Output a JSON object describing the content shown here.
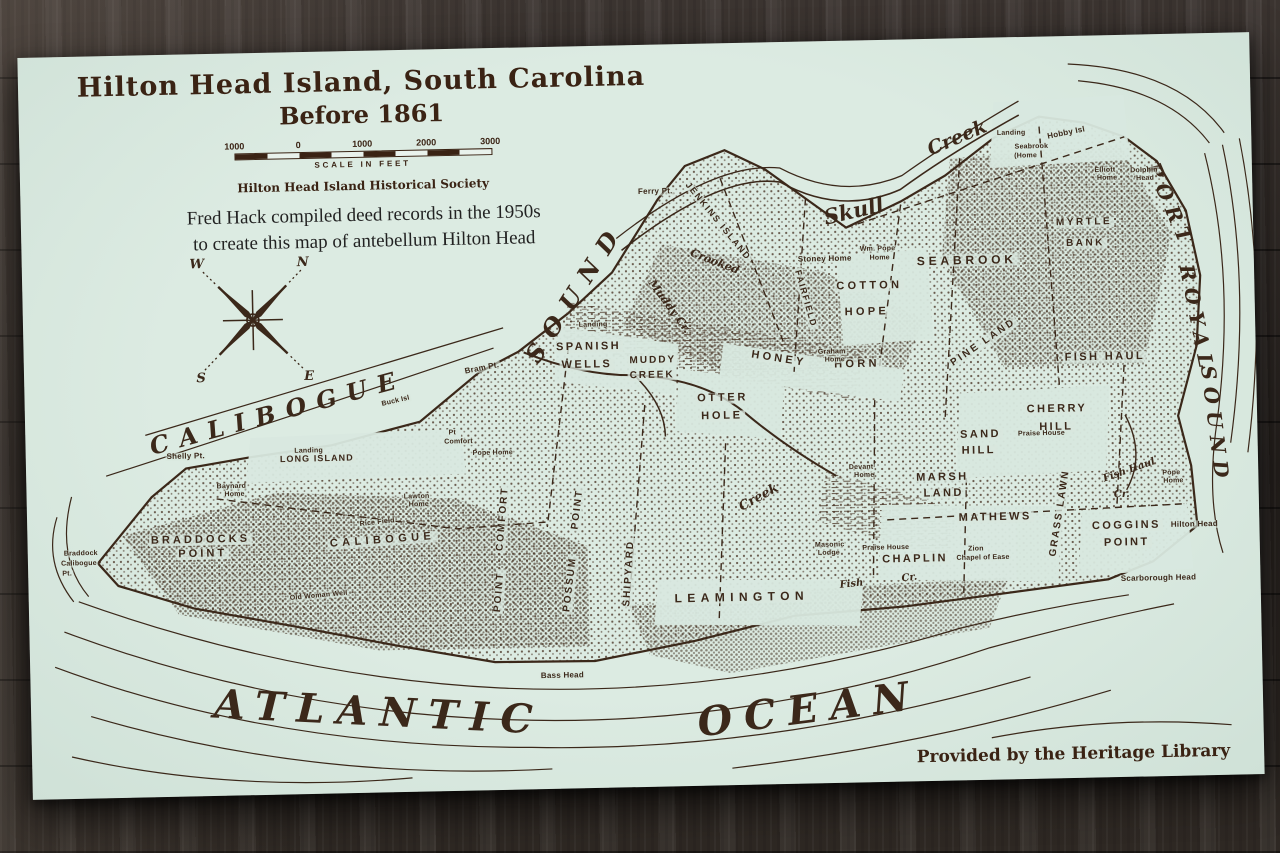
{
  "colors": {
    "paper": "#d6e7de",
    "ink": "#3b281a",
    "wood_dark": "#241f1c",
    "wood_light": "#4b433d"
  },
  "header": {
    "title_line1": "Hilton Head Island,  South Carolina",
    "title_line2": "Before 1861",
    "scale_ticks": [
      "1000",
      "0",
      "1000",
      "2000",
      "3000"
    ],
    "scale_caption": "SCALE IN FEET",
    "society": "Hilton Head Island Historical Society",
    "caption_line1": "Fred Hack compiled deed records in the 1950s",
    "caption_line2": "to create this map of antebellum Hilton Head"
  },
  "compass": {
    "n": "N",
    "e": "E",
    "s": "S",
    "w": "W"
  },
  "credit": "Provided by the Heritage Library",
  "labels": [
    {
      "t": "CALIBOGUE",
      "x": 253,
      "y": 360,
      "s": 24,
      "cls": "water-lg",
      "r": -14,
      "ls": 0.45
    },
    {
      "t": "SOUND",
      "x": 553,
      "y": 246,
      "s": 24,
      "cls": "water-lg",
      "r": -56,
      "ls": 0.5
    },
    {
      "t": "ATLANTIC",
      "x": 348,
      "y": 662,
      "s": 40,
      "cls": "ocean",
      "r": 4,
      "ls": 0.3
    },
    {
      "t": "OCEAN",
      "x": 778,
      "y": 668,
      "s": 40,
      "cls": "ocean",
      "r": -6,
      "ls": 0.3
    },
    {
      "t": "PORT",
      "x": 1150,
      "y": 172,
      "s": 20,
      "cls": "water-lg",
      "r": 68,
      "ls": 0.35
    },
    {
      "t": "ROYAL",
      "x": 1174,
      "y": 286,
      "s": 20,
      "cls": "water-lg",
      "r": 80,
      "ls": 0.35
    },
    {
      "t": "SOUND",
      "x": 1190,
      "y": 392,
      "s": 20,
      "cls": "water-lg",
      "r": 84,
      "ls": 0.35
    },
    {
      "t": "Skull",
      "x": 833,
      "y": 170,
      "s": 21,
      "cls": "script",
      "r": -12
    },
    {
      "t": "Creek",
      "x": 938,
      "y": 100,
      "s": 19,
      "cls": "script",
      "r": -22
    },
    {
      "t": "Muddy Cr.",
      "x": 647,
      "y": 262,
      "s": 11,
      "cls": "script",
      "r": 55
    },
    {
      "t": "Crooked",
      "x": 693,
      "y": 218,
      "s": 11,
      "cls": "script",
      "r": 22
    },
    {
      "t": "Creek",
      "x": 732,
      "y": 455,
      "s": 13,
      "cls": "script",
      "r": -28
    },
    {
      "t": "Fish Haul",
      "x": 1103,
      "y": 436,
      "s": 10,
      "cls": "script",
      "r": -18
    },
    {
      "t": "Cr.",
      "x": 1095,
      "y": 460,
      "s": 10,
      "cls": "script",
      "r": 0
    },
    {
      "t": "Fish",
      "x": 823,
      "y": 544,
      "s": 10,
      "cls": "script",
      "r": -5
    },
    {
      "t": "Cr.",
      "x": 881,
      "y": 539,
      "s": 10,
      "cls": "script",
      "r": -5
    },
    {
      "t": "JENKINS ISLAND",
      "x": 697,
      "y": 178,
      "s": 9,
      "cls": "place",
      "r": 52,
      "ls": 0.18
    },
    {
      "t": "FAIRFIELD",
      "x": 783,
      "y": 257,
      "s": 9,
      "cls": "place",
      "r": 75,
      "ls": 0.15
    },
    {
      "t": "COTTON",
      "x": 847,
      "y": 246,
      "s": 11,
      "cls": "place",
      "ls": 0.3
    },
    {
      "t": "HOPE",
      "x": 844,
      "y": 272,
      "s": 11,
      "cls": "place",
      "ls": 0.3
    },
    {
      "t": "SEABROOK",
      "x": 945,
      "y": 222,
      "s": 12,
      "cls": "place",
      "ls": 0.32
    },
    {
      "t": "MYRTLE",
      "x": 1063,
      "y": 187,
      "s": 10,
      "cls": "place",
      "ls": 0.25
    },
    {
      "t": "BANK",
      "x": 1064,
      "y": 208,
      "s": 10,
      "cls": "place",
      "ls": 0.25
    },
    {
      "t": "SPANISH",
      "x": 565,
      "y": 301,
      "s": 11,
      "cls": "place",
      "ls": 0.22
    },
    {
      "t": "WELLS",
      "x": 563,
      "y": 319,
      "s": 11,
      "cls": "place",
      "ls": 0.22
    },
    {
      "t": "MUDDY",
      "x": 629,
      "y": 316,
      "s": 10,
      "cls": "place",
      "ls": 0.2
    },
    {
      "t": "CREEK",
      "x": 628,
      "y": 331,
      "s": 10,
      "cls": "place",
      "ls": 0.2
    },
    {
      "t": "OTTER",
      "x": 698,
      "y": 355,
      "s": 11,
      "cls": "place",
      "ls": 0.25
    },
    {
      "t": "HOLE",
      "x": 697,
      "y": 373,
      "s": 11,
      "cls": "place",
      "ls": 0.25
    },
    {
      "t": "HONEY",
      "x": 755,
      "y": 317,
      "s": 11,
      "cls": "place",
      "r": 10,
      "ls": 0.3
    },
    {
      "t": "HORN",
      "x": 833,
      "y": 324,
      "s": 11,
      "cls": "place",
      "ls": 0.3
    },
    {
      "t": "PINE LAND",
      "x": 960,
      "y": 305,
      "s": 10,
      "cls": "place",
      "r": -33,
      "ls": 0.25
    },
    {
      "t": "FISH HAUL",
      "x": 1081,
      "y": 322,
      "s": 11,
      "cls": "place",
      "ls": 0.22
    },
    {
      "t": "CHERRY",
      "x": 1032,
      "y": 373,
      "s": 11,
      "cls": "place",
      "ls": 0.22
    },
    {
      "t": "HILL",
      "x": 1031,
      "y": 391,
      "s": 11,
      "cls": "place",
      "ls": 0.22
    },
    {
      "t": "SAND",
      "x": 955,
      "y": 397,
      "s": 11,
      "cls": "place",
      "ls": 0.22
    },
    {
      "t": "HILL",
      "x": 953,
      "y": 413,
      "s": 11,
      "cls": "place",
      "ls": 0.22
    },
    {
      "t": "MARSH",
      "x": 916,
      "y": 439,
      "s": 11,
      "cls": "place",
      "ls": 0.22
    },
    {
      "t": "LAND",
      "x": 917,
      "y": 455,
      "s": 11,
      "cls": "place",
      "ls": 0.22
    },
    {
      "t": "MATHEWS",
      "x": 968,
      "y": 480,
      "s": 11,
      "cls": "place",
      "ls": 0.22
    },
    {
      "t": "CHAPLIN",
      "x": 887,
      "y": 520,
      "s": 11,
      "cls": "place",
      "ls": 0.22
    },
    {
      "t": "GRASS LAWN",
      "x": 1033,
      "y": 477,
      "s": 10,
      "cls": "place",
      "r": -80,
      "ls": 0.2
    },
    {
      "t": "COGGINS",
      "x": 1099,
      "y": 491,
      "s": 11,
      "cls": "place",
      "ls": 0.22
    },
    {
      "t": "POINT",
      "x": 1099,
      "y": 508,
      "s": 11,
      "cls": "place",
      "ls": 0.22
    },
    {
      "t": "LEAMINGTON",
      "x": 713,
      "y": 554,
      "s": 12,
      "cls": "place",
      "ls": 0.45
    },
    {
      "t": "SHIPYARD",
      "x": 601,
      "y": 528,
      "s": 10,
      "cls": "place",
      "r": -85,
      "ls": 0.2
    },
    {
      "t": "POSSUM",
      "x": 542,
      "y": 538,
      "s": 10,
      "cls": "place",
      "r": -82,
      "ls": 0.2
    },
    {
      "t": "POINT",
      "x": 551,
      "y": 463,
      "s": 10,
      "cls": "place",
      "r": -82,
      "ls": 0.2
    },
    {
      "t": "COMFORT",
      "x": 476,
      "y": 471,
      "s": 10,
      "cls": "place",
      "r": -84,
      "ls": 0.2
    },
    {
      "t": "POINT",
      "x": 471,
      "y": 544,
      "s": 10,
      "cls": "place",
      "r": -84,
      "ls": 0.2
    },
    {
      "t": "CALIBOGUE",
      "x": 355,
      "y": 490,
      "s": 11,
      "cls": "place",
      "r": -3,
      "ls": 0.4
    },
    {
      "t": "BRADDOCKS",
      "x": 173,
      "y": 486,
      "s": 11,
      "cls": "place",
      "ls": 0.28
    },
    {
      "t": "POINT",
      "x": 175,
      "y": 500,
      "s": 11,
      "cls": "place",
      "ls": 0.28
    },
    {
      "t": "LONG ISLAND",
      "x": 291,
      "y": 407,
      "s": 9,
      "cls": "place",
      "ls": 0.12
    },
    {
      "t": "Ferry Pt.",
      "x": 635,
      "y": 147,
      "s": 8,
      "cls": "tiny"
    },
    {
      "t": "Stoney Home",
      "x": 803,
      "y": 218,
      "s": 8,
      "cls": "tiny"
    },
    {
      "t": "Wm. Pope",
      "x": 856,
      "y": 209,
      "s": 7,
      "cls": "tiny"
    },
    {
      "t": "Home",
      "x": 858,
      "y": 218,
      "s": 7,
      "cls": "tiny"
    },
    {
      "t": "Landing",
      "x": 570,
      "y": 279,
      "s": 7,
      "cls": "tiny"
    },
    {
      "t": "Landing",
      "x": 992,
      "y": 96,
      "s": 7,
      "cls": "tiny"
    },
    {
      "t": "Seabrook",
      "x": 1012,
      "y": 110,
      "s": 7,
      "cls": "tiny"
    },
    {
      "t": "(Home",
      "x": 1006,
      "y": 119,
      "s": 7,
      "cls": "tiny"
    },
    {
      "t": "Hobby Isl",
      "x": 1047,
      "y": 97,
      "s": 8,
      "cls": "tiny",
      "r": -10
    },
    {
      "t": "Elliott",
      "x": 1085,
      "y": 135,
      "s": 7,
      "cls": "tiny"
    },
    {
      "t": "Home",
      "x": 1087,
      "y": 143,
      "s": 7,
      "cls": "tiny"
    },
    {
      "t": "Dolphin",
      "x": 1124,
      "y": 136,
      "s": 7,
      "cls": "tiny"
    },
    {
      "t": "Head",
      "x": 1125,
      "y": 144,
      "s": 7,
      "cls": "tiny"
    },
    {
      "t": "Graham",
      "x": 808,
      "y": 311,
      "s": 7,
      "cls": "tiny"
    },
    {
      "t": "Home",
      "x": 811,
      "y": 319,
      "s": 7,
      "cls": "tiny"
    },
    {
      "t": "Praise House",
      "x": 1016,
      "y": 397,
      "s": 7,
      "cls": "tiny"
    },
    {
      "t": "Devant",
      "x": 835,
      "y": 427,
      "s": 7,
      "cls": "tiny"
    },
    {
      "t": "Home",
      "x": 838,
      "y": 435,
      "s": 7,
      "cls": "tiny"
    },
    {
      "t": "Masonic",
      "x": 802,
      "y": 504,
      "s": 7,
      "cls": "tiny"
    },
    {
      "t": "Lodge",
      "x": 801,
      "y": 512,
      "s": 7,
      "cls": "tiny"
    },
    {
      "t": "Praise House",
      "x": 858,
      "y": 508,
      "s": 7,
      "cls": "tiny"
    },
    {
      "t": "Zion",
      "x": 948,
      "y": 511,
      "s": 7,
      "cls": "tiny"
    },
    {
      "t": "Chapel of Ease",
      "x": 955,
      "y": 520,
      "s": 7,
      "cls": "tiny"
    },
    {
      "t": "Pope",
      "x": 1145,
      "y": 439,
      "s": 7,
      "cls": "tiny"
    },
    {
      "t": "Home",
      "x": 1147,
      "y": 447,
      "s": 7,
      "cls": "tiny"
    },
    {
      "t": "Hilton Head",
      "x": 1167,
      "y": 491,
      "s": 8,
      "cls": "tiny"
    },
    {
      "t": "Scarborough Head",
      "x": 1130,
      "y": 544,
      "s": 8,
      "cls": "tiny"
    },
    {
      "t": "Pt",
      "x": 427,
      "y": 384,
      "s": 7,
      "cls": "tiny"
    },
    {
      "t": "Comfort",
      "x": 433,
      "y": 393,
      "s": 7,
      "cls": "tiny"
    },
    {
      "t": "Pope Home",
      "x": 467,
      "y": 405,
      "s": 7,
      "cls": "tiny"
    },
    {
      "t": "Bram Pt.",
      "x": 458,
      "y": 320,
      "s": 8,
      "cls": "tiny",
      "r": -10
    },
    {
      "t": "Buck Isl",
      "x": 371,
      "y": 351,
      "s": 7,
      "cls": "tiny",
      "r": -12
    },
    {
      "t": "Shelly Pt.",
      "x": 160,
      "y": 402,
      "s": 8,
      "cls": "tiny"
    },
    {
      "t": "Landing",
      "x": 283,
      "y": 399,
      "s": 7,
      "cls": "tiny"
    },
    {
      "t": "Baynard",
      "x": 205,
      "y": 433,
      "s": 7,
      "cls": "tiny"
    },
    {
      "t": "Home",
      "x": 208,
      "y": 441,
      "s": 7,
      "cls": "tiny"
    },
    {
      "t": "Lawton",
      "x": 390,
      "y": 447,
      "s": 7,
      "cls": "tiny"
    },
    {
      "t": "Home",
      "x": 392,
      "y": 455,
      "s": 7,
      "cls": "tiny"
    },
    {
      "t": "Braddock",
      "x": 53,
      "y": 497,
      "s": 7,
      "cls": "tiny"
    },
    {
      "t": "Calibogue",
      "x": 51,
      "y": 507,
      "s": 7,
      "cls": "tiny"
    },
    {
      "t": "Pt.",
      "x": 39,
      "y": 517,
      "s": 7,
      "cls": "tiny"
    },
    {
      "t": "Rice Field",
      "x": 350,
      "y": 472,
      "s": 7,
      "cls": "tiny",
      "r": -5
    },
    {
      "t": "Old Woman Well",
      "x": 290,
      "y": 544,
      "s": 7,
      "cls": "tiny",
      "r": -4
    },
    {
      "t": "Bass Head",
      "x": 532,
      "y": 629,
      "s": 8,
      "cls": "tiny"
    }
  ]
}
